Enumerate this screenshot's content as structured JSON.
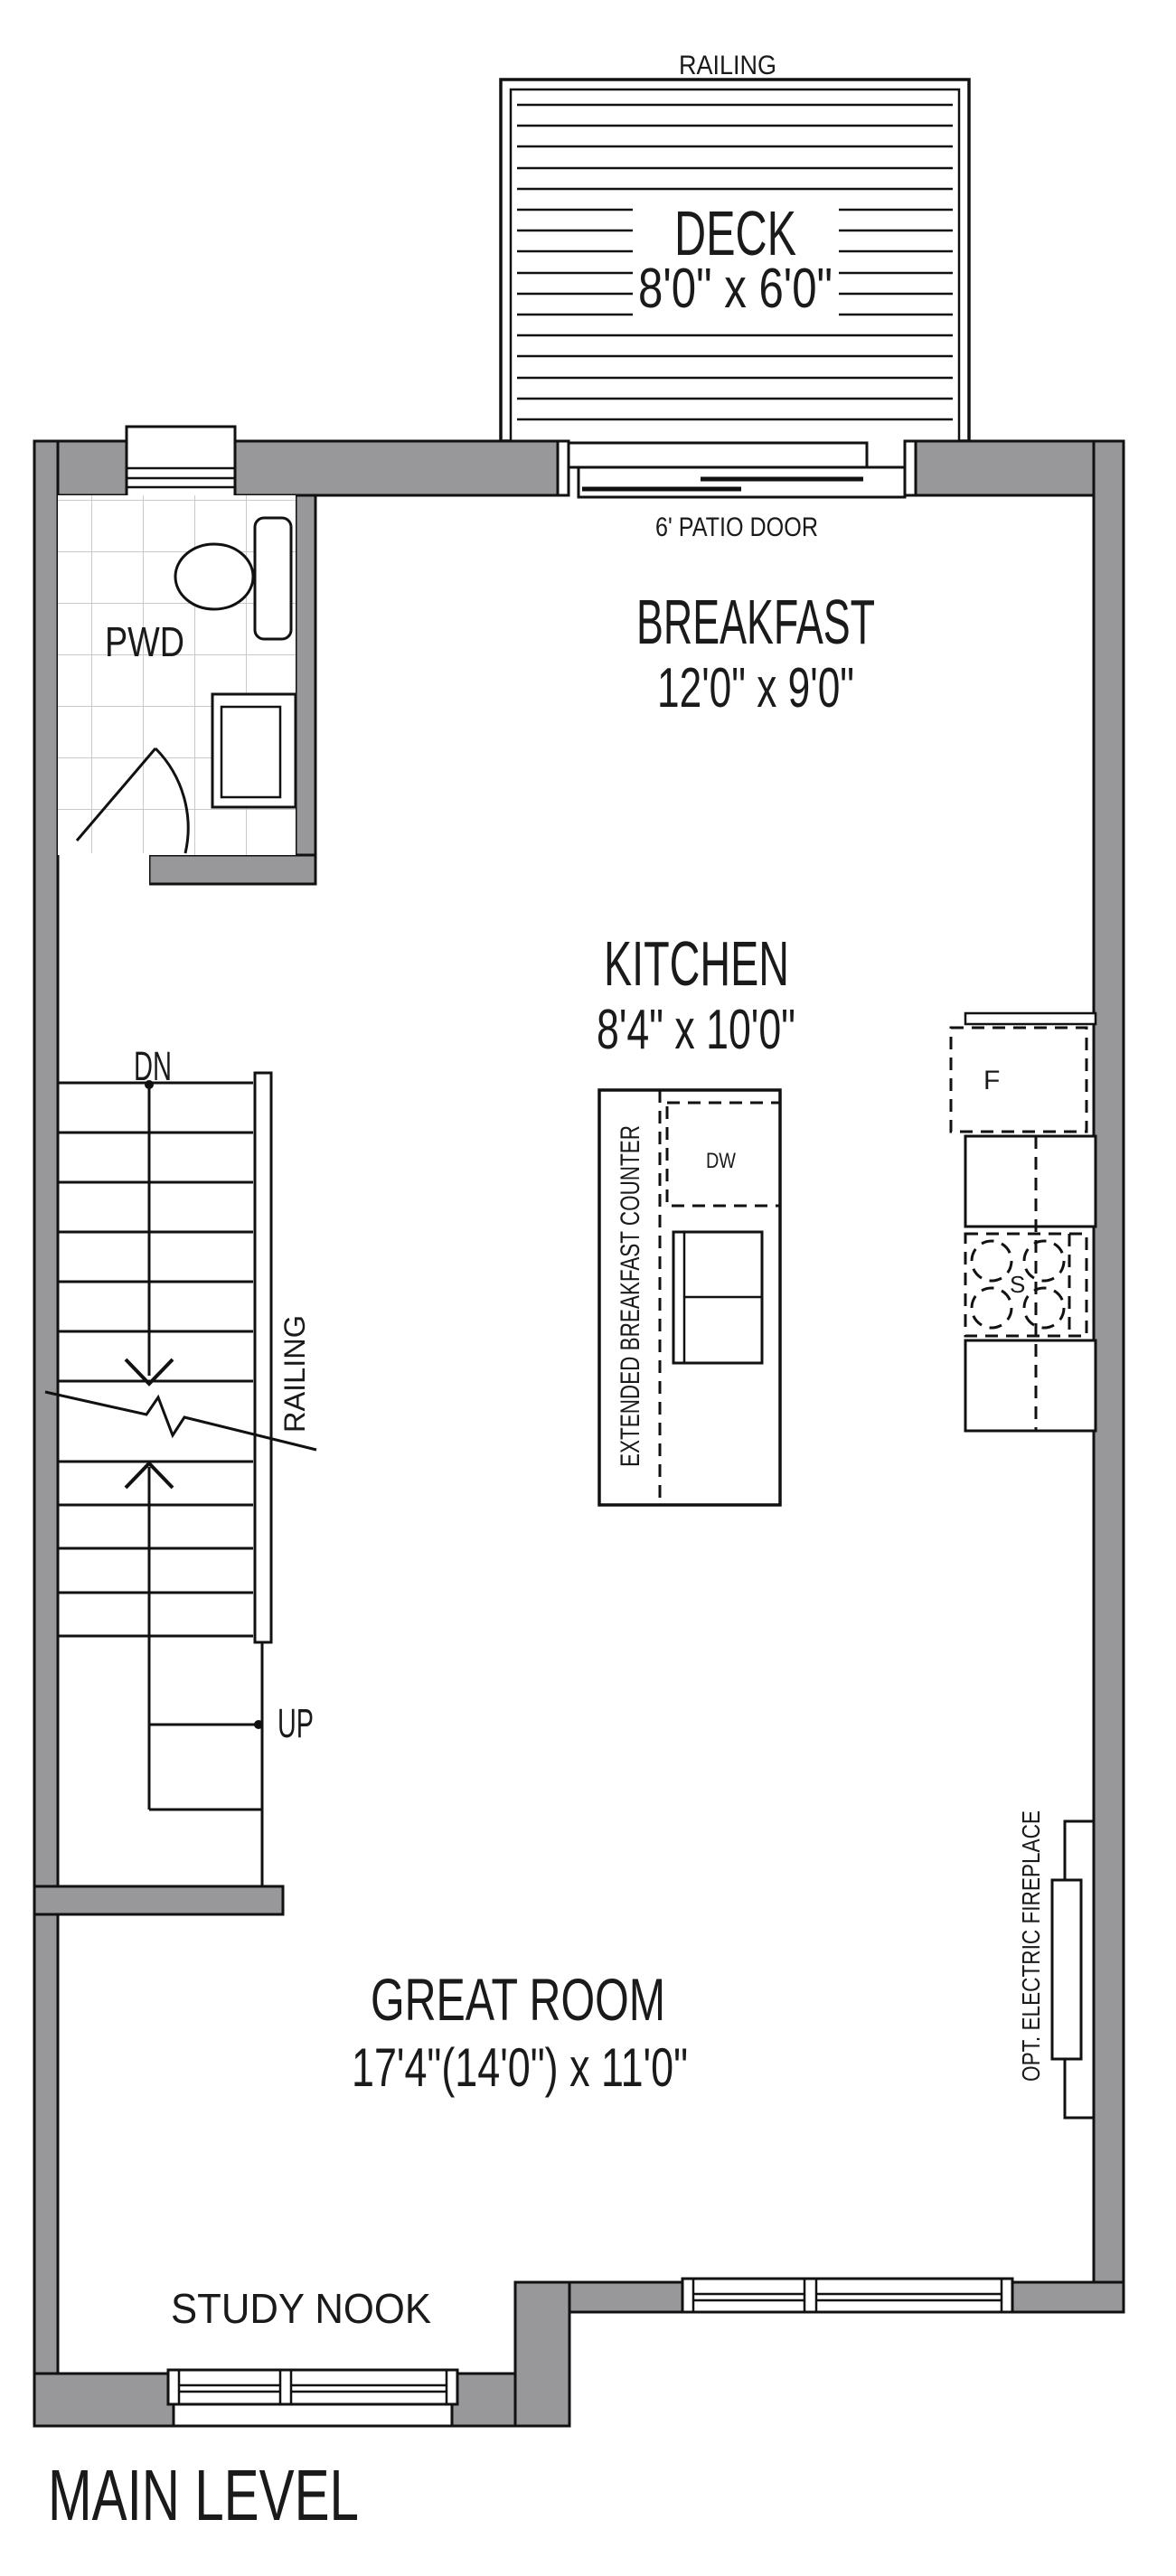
{
  "title": "MAIN LEVEL",
  "colors": {
    "wall": "#98989a",
    "line": "#111111",
    "tile": "#c9c9c9",
    "text": "#1a1a1a"
  },
  "deck": {
    "label": "DECK",
    "dims": "8'0\" x 6'0\"",
    "railing_label": "RAILING"
  },
  "patio_door": {
    "label": "6' PATIO DOOR"
  },
  "rooms": {
    "breakfast": {
      "label": "BREAKFAST",
      "dims": "12'0\" x 9'0\""
    },
    "kitchen": {
      "label": "KITCHEN",
      "dims": "8'4\" x 10'0\""
    },
    "great_room": {
      "label": "GREAT ROOM",
      "dims": "17'4\"(14'0\") x 11'0\""
    },
    "pwd": {
      "label": "PWD"
    },
    "study_nook": {
      "label": "STUDY NOOK"
    }
  },
  "stairs": {
    "down_label": "DN",
    "up_label": "UP",
    "railing_label": "RAILING"
  },
  "kitchen_features": {
    "island_label": "EXTENDED BREAKFAST COUNTER",
    "dishwasher_label": "DW",
    "fridge_label": "F",
    "stove_label": "S"
  },
  "fireplace_label": "OPT. ELECTRIC FIREPLACE"
}
